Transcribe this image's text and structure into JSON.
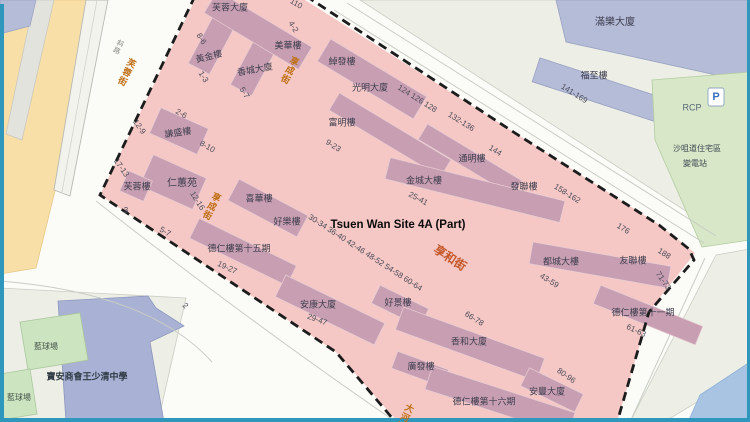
{
  "map": {
    "site_label": "Tsuen Wan Site 4A (Part)",
    "parking_label": "P",
    "colors": {
      "site_fill": "#f5c8c5",
      "site_building": "#c89fb2",
      "boundary_dash": "#1c1c1c",
      "street_label_orange": "#bf6f15",
      "heung_wo_street_orange": "#c4582a",
      "outside_block": "#edefe6",
      "outside_building_lavender": "#b5bcd8",
      "green_area": "#d7e7c7",
      "yellow_road": "#f8dfa8",
      "water_blue": "#a9c4e2",
      "edge_border_blue": "#2f96bc"
    },
    "labels": {
      "streets": [
        {
          "text": "芙蓉街",
          "x": 126,
          "y": 72,
          "rot": 26,
          "vertical": true
        },
        {
          "text": "享成街",
          "x": 289,
          "y": 70,
          "rot": 26,
          "vertical": true
        },
        {
          "text": "享成街",
          "x": 211,
          "y": 206,
          "rot": 26,
          "vertical": true
        },
        {
          "text": "享和街",
          "x": 450,
          "y": 258,
          "rot": 33,
          "size": 12,
          "color": "#c4582a"
        },
        {
          "text": "大河道",
          "x": 404,
          "y": 417,
          "rot": 26,
          "vertical": true
        }
      ],
      "buildings": [
        {
          "text": "芙蓉大廈",
          "x": 230,
          "y": 8
        },
        {
          "text": "美華樓",
          "x": 288,
          "y": 46
        },
        {
          "text": "黃金樓",
          "x": 209,
          "y": 57,
          "rot": -14
        },
        {
          "text": "香城大廈",
          "x": 255,
          "y": 70,
          "rot": -10
        },
        {
          "text": "綽發樓",
          "x": 342,
          "y": 62
        },
        {
          "text": "光明大廈",
          "x": 370,
          "y": 88
        },
        {
          "text": "富明樓",
          "x": 342,
          "y": 123
        },
        {
          "text": "通明樓",
          "x": 472,
          "y": 159
        },
        {
          "text": "金城大樓",
          "x": 424,
          "y": 181
        },
        {
          "text": "發聯樓",
          "x": 524,
          "y": 187
        },
        {
          "text": "都城大樓",
          "x": 561,
          "y": 262
        },
        {
          "text": "友聯樓",
          "x": 633,
          "y": 261
        },
        {
          "text": "德仁樓第十一期",
          "x": 643,
          "y": 313
        },
        {
          "text": "謙盛樓",
          "x": 178,
          "y": 133,
          "rot": -8
        },
        {
          "text": "仁蕙苑",
          "x": 182,
          "y": 184,
          "size": 10
        },
        {
          "text": "芙蓉樓",
          "x": 137,
          "y": 187
        },
        {
          "text": "喜華樓",
          "x": 259,
          "y": 199
        },
        {
          "text": "好樂樓",
          "x": 287,
          "y": 222
        },
        {
          "text": "德仁樓第十五期",
          "x": 239,
          "y": 249
        },
        {
          "text": "安康大廈",
          "x": 318,
          "y": 305
        },
        {
          "text": "好景樓",
          "x": 398,
          "y": 303
        },
        {
          "text": "香和大廈",
          "x": 469,
          "y": 342
        },
        {
          "text": "廣發樓",
          "x": 421,
          "y": 367
        },
        {
          "text": "德仁樓第十六期",
          "x": 484,
          "y": 402
        },
        {
          "text": "安豐大廈",
          "x": 547,
          "y": 392
        }
      ],
      "numbers": [
        {
          "text": "8-6",
          "x": 201,
          "y": 39,
          "rot": 58
        },
        {
          "text": "1-3",
          "x": 203,
          "y": 77,
          "rot": 58
        },
        {
          "text": "5-7",
          "x": 244,
          "y": 93,
          "rot": 58
        },
        {
          "text": "4-2",
          "x": 293,
          "y": 27,
          "rot": 58
        },
        {
          "text": "110",
          "x": 296,
          "y": 4,
          "rot": 30
        },
        {
          "text": "2-6",
          "x": 181,
          "y": 114,
          "rot": 30
        },
        {
          "text": "12-9",
          "x": 139,
          "y": 127,
          "rot": 55
        },
        {
          "text": "8-10",
          "x": 207,
          "y": 147,
          "rot": 30
        },
        {
          "text": "17-13",
          "x": 121,
          "y": 168,
          "rot": 55
        },
        {
          "text": "12-16",
          "x": 197,
          "y": 201,
          "rot": 58
        },
        {
          "text": "3",
          "x": 126,
          "y": 211,
          "rot": 0
        },
        {
          "text": "5-7",
          "x": 165,
          "y": 232,
          "rot": 30
        },
        {
          "text": "2",
          "x": 185,
          "y": 306,
          "rot": 45
        },
        {
          "text": "9-23",
          "x": 333,
          "y": 146,
          "rot": 32
        },
        {
          "text": "124 126 128",
          "x": 417,
          "y": 99,
          "rot": 32
        },
        {
          "text": "132-136",
          "x": 461,
          "y": 122,
          "rot": 32
        },
        {
          "text": "144",
          "x": 495,
          "y": 151,
          "rot": 32
        },
        {
          "text": "141-169",
          "x": 574,
          "y": 94,
          "rot": 32
        },
        {
          "text": "158-162",
          "x": 567,
          "y": 194,
          "rot": 32
        },
        {
          "text": "176",
          "x": 623,
          "y": 229,
          "rot": 32
        },
        {
          "text": "188",
          "x": 664,
          "y": 254,
          "rot": 32
        },
        {
          "text": "71-73",
          "x": 663,
          "y": 281,
          "rot": 55
        },
        {
          "text": "43-59",
          "x": 549,
          "y": 281,
          "rot": 32
        },
        {
          "text": "61-63",
          "x": 636,
          "y": 331,
          "rot": 25
        },
        {
          "text": "25-41",
          "x": 418,
          "y": 199,
          "rot": 28
        },
        {
          "text": "19-27",
          "x": 227,
          "y": 268,
          "rot": 25
        },
        {
          "text": "30-34 36-40 42-46 48-52 54-58 60-64",
          "x": 365,
          "y": 253,
          "rot": 33
        },
        {
          "text": "29-47",
          "x": 317,
          "y": 320,
          "rot": 20
        },
        {
          "text": "66-78",
          "x": 474,
          "y": 319,
          "rot": 32
        },
        {
          "text": "80-96",
          "x": 566,
          "y": 376,
          "rot": 35
        }
      ],
      "places": [
        {
          "text": "斜路",
          "x": 118,
          "y": 47,
          "rot": 26,
          "vertical": true,
          "size": 7,
          "color": "#8a8a86"
        },
        {
          "text": "RCP",
          "x": 692,
          "y": 108,
          "size": 9,
          "color": "#5a6b7a"
        },
        {
          "text": "沙咀道住宅區",
          "x": 697,
          "y": 149
        },
        {
          "text": "變電站",
          "x": 695,
          "y": 164
        },
        {
          "text": "滿樂大廈",
          "x": 615,
          "y": 23,
          "size": 10,
          "color": "#3d3d4d"
        },
        {
          "text": "福至樓",
          "x": 594,
          "y": 76,
          "size": 9,
          "color": "#3d3d4d"
        },
        {
          "text": "藍球場",
          "x": 46,
          "y": 347,
          "color": "#46564c"
        },
        {
          "text": "藍球場",
          "x": 19,
          "y": 398,
          "color": "#46564c"
        },
        {
          "text": "寶安商會王少清中學",
          "x": 87,
          "y": 377,
          "size": 9,
          "color": "#2f3a44",
          "bold": true
        }
      ]
    }
  }
}
